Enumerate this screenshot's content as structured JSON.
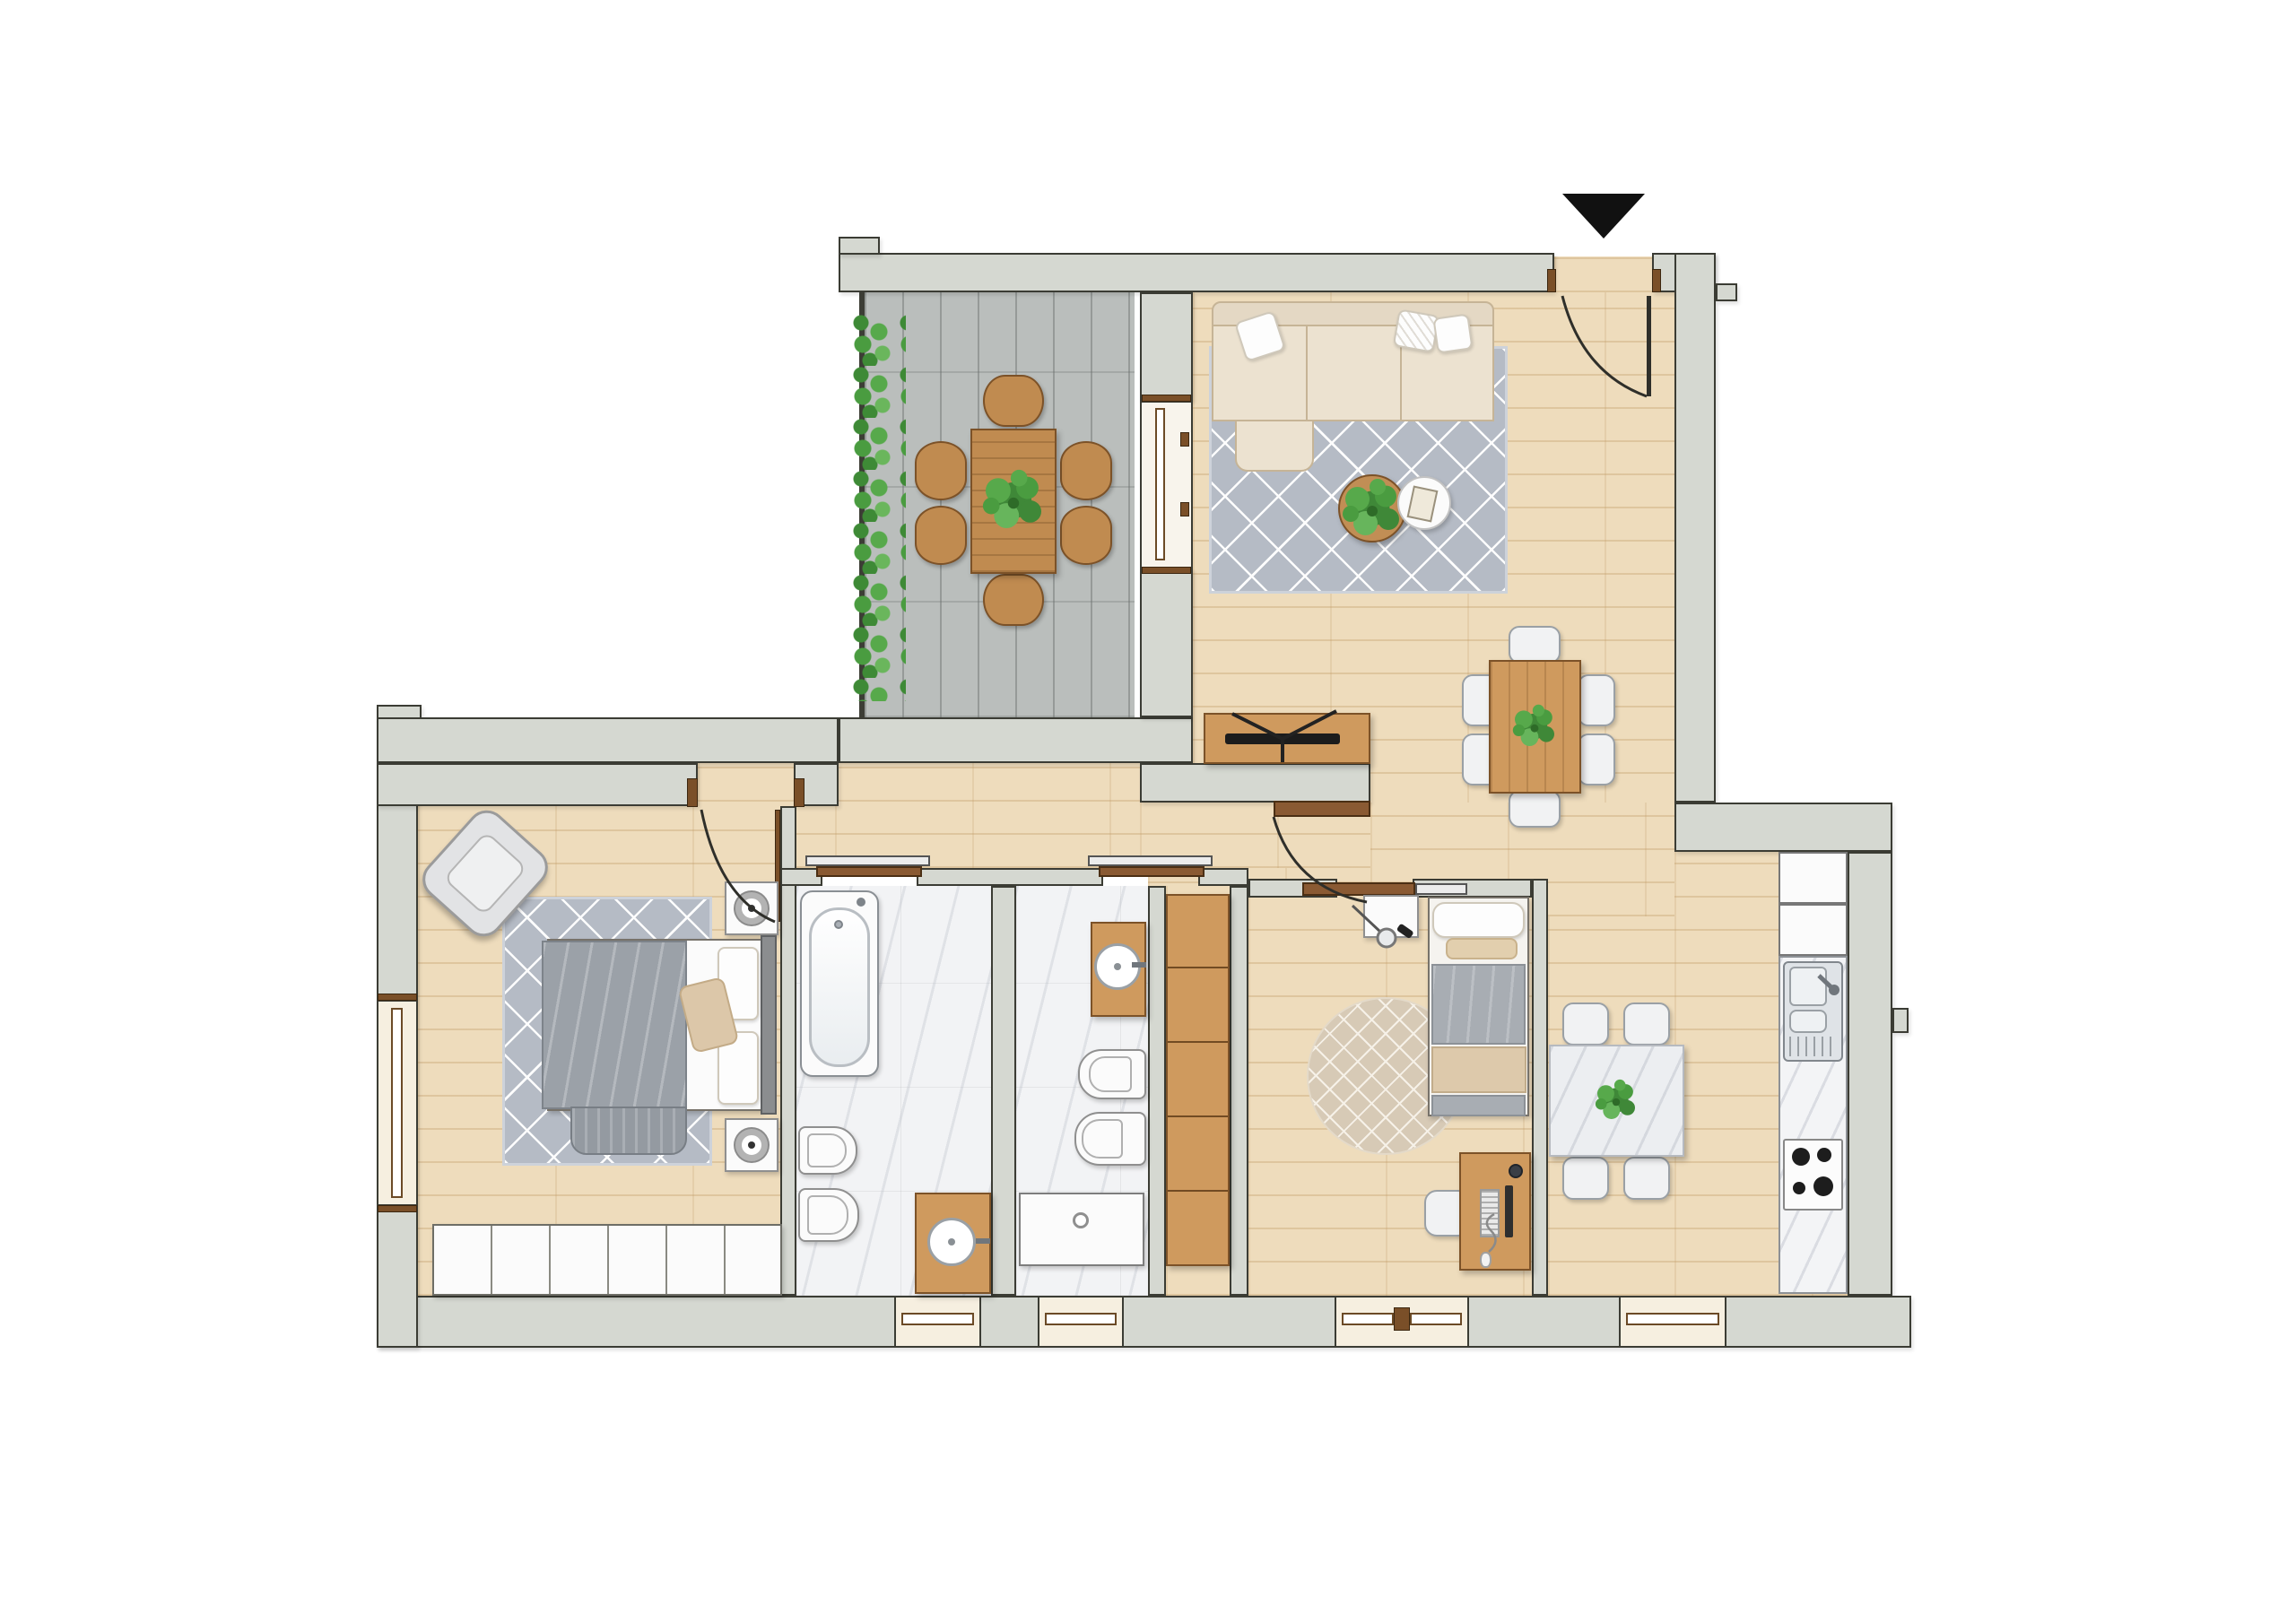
{
  "document": {
    "kind": "residential floor plan rendering (top-down)",
    "visible_text": "none — the drawing contains no labels, dimensions or captions",
    "entrance_marker": {
      "shape": "filled-triangle-pointing-down",
      "color": "#111111",
      "position": "above entrance door, top right"
    }
  },
  "palette": {
    "background": "#ffffff",
    "wall_fill": "#d5d8d1",
    "wall_outline": "#3b3c34",
    "wood_floor": "#eedcbc",
    "terrace_stone": "#babebc",
    "bathroom_marble": "#f2f3f5",
    "rug_gray": "#b5bbc5",
    "rug_beige": "#d7cab6",
    "wood_furniture": "#cf9a5e",
    "outdoor_wood": "#c08b50",
    "sofa_beige": "#ece2d0",
    "blanket_gray": "#9ba1a8",
    "door_brown": "#8a5a33",
    "window_sill_cream": "#f6efe0",
    "plant_green": "#4a9c40",
    "appliance_white": "#fbfbfb"
  },
  "rooms": [
    {
      "id": "terrace",
      "name": "terrace",
      "floor": "stone tiles",
      "items": [
        "hedge planter",
        "outdoor dining table",
        "6 outdoor chairs",
        "sliding glass door to living room"
      ]
    },
    {
      "id": "living-dining",
      "name": "living / dining room",
      "floor": "wood",
      "items": [
        "corner sofa with 3 pillows",
        "gray diamond rug",
        "round wood coffee table with plant",
        "round white side table with book",
        "tv sideboard with tv",
        "dining table with plant",
        "6 white chairs",
        "entrance door"
      ]
    },
    {
      "id": "hallway",
      "name": "hallway",
      "floor": "wood",
      "items": [
        "built-in wardrobe column",
        "doors to bedroom, bathrooms and kids room"
      ]
    },
    {
      "id": "master-bedroom",
      "name": "master bedroom",
      "floor": "wood",
      "items": [
        "armchair",
        "gray diamond rug",
        "double bed with gray blanket",
        "2 nightstands with lamps",
        "built-in wardrobe"
      ]
    },
    {
      "id": "bathroom-1",
      "name": "bathroom 1",
      "floor": "marble",
      "items": [
        "bathtub",
        "bidet",
        "toilet",
        "wood vanity with round sink",
        "sliding door",
        "window"
      ]
    },
    {
      "id": "bathroom-2",
      "name": "bathroom 2",
      "floor": "marble",
      "items": [
        "wood vanity with round sink",
        "bidet",
        "toilet",
        "washing machine",
        "sliding door",
        "window"
      ]
    },
    {
      "id": "kids-bedroom",
      "name": "kids bedroom",
      "floor": "wood",
      "items": [
        "single bed",
        "nightstand with pendant lamp",
        "round beige rug",
        "desk with monitor, keyboard, mouse",
        "desk chair",
        "double window"
      ]
    },
    {
      "id": "kitchen",
      "name": "kitchen",
      "floor": "wood",
      "items": [
        "marble dining table",
        "4 white chairs",
        "tall white cabinets / fridge",
        "marble counter",
        "double sink with drainboard",
        "4-burner gas hob",
        "window"
      ]
    }
  ],
  "openings": {
    "entrance_door": 1,
    "hinged_interior_doors": 2,
    "sliding_doors": 3,
    "windows": 6
  }
}
